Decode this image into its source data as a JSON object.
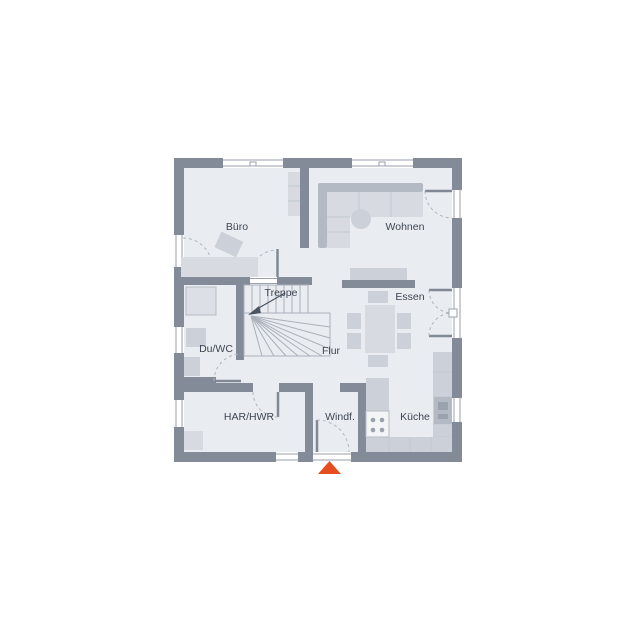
{
  "rooms": {
    "buero": "Büro",
    "wohnen": "Wohnen",
    "treppe": "Treppe",
    "essen": "Essen",
    "duwc": "Du/WC",
    "flur": "Flur",
    "har_hwr": "HAR/HWR",
    "windf": "Windf.",
    "kueche": "Küche"
  },
  "colors": {
    "wall": "#828b97",
    "floor": "#e9edf1",
    "furniture_light": "#d7dbe1",
    "furniture_mid": "#ccd1d9",
    "furniture_dark": "#b4bac4",
    "window_frame": "#9aa1ac",
    "label_text": "#3e4653",
    "entrance_accent": "#e64e1f"
  }
}
